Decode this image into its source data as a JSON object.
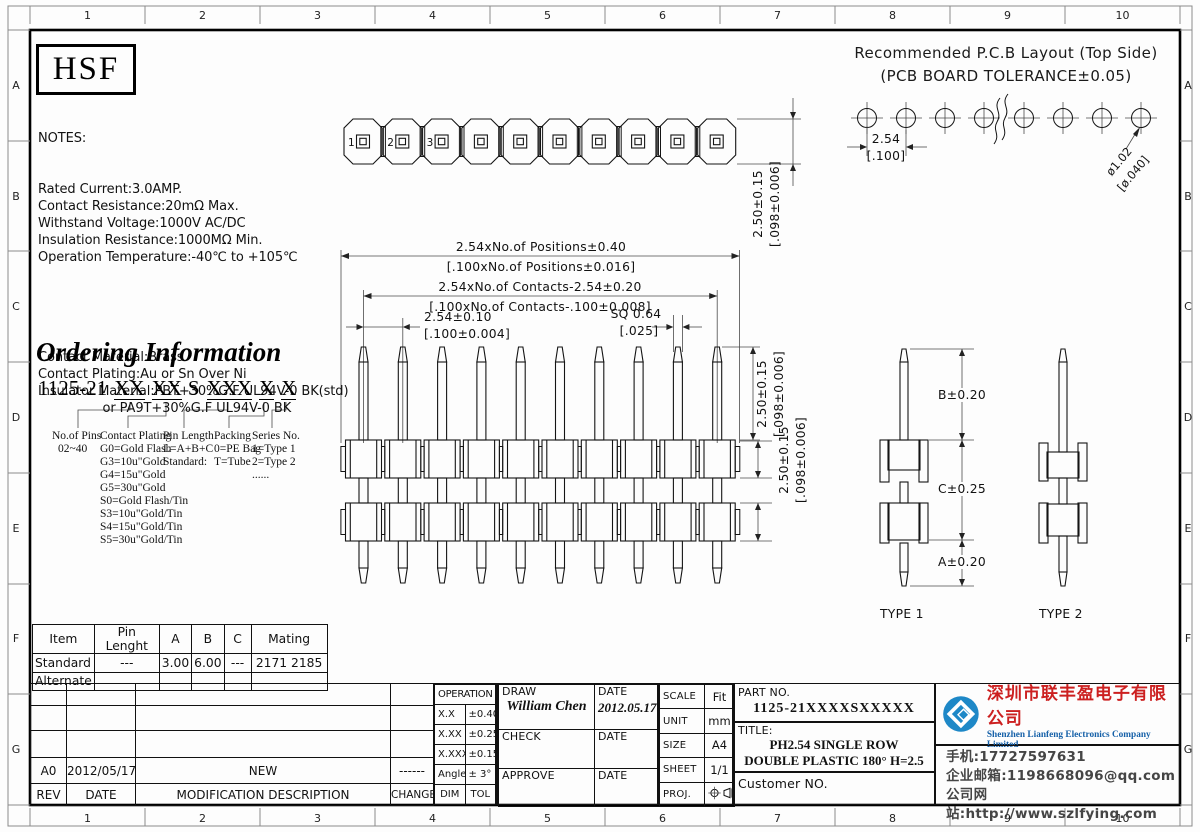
{
  "sheet": {
    "numbers": [
      "1",
      "2",
      "3",
      "4",
      "5",
      "6",
      "7",
      "8",
      "9",
      "10"
    ],
    "letters": [
      "A",
      "B",
      "C",
      "D",
      "E",
      "F",
      "G"
    ]
  },
  "header": {
    "logo": "HSF"
  },
  "notes": {
    "heading": "NOTES:",
    "electrical": [
      "Rated Current:3.0AMP.",
      "Contact Resistance:20mΩ Max.",
      "Withstand Voltage:1000V AC/DC",
      "Insulation Resistance:1000MΩ Min.",
      "Operation Temperature:-40℃ to +105℃"
    ],
    "material": [
      "Contact Material:Brass",
      "Contact Plating:Au or Sn Over Ni",
      "Insulator Material:PBT+30%G.F UL94V-0 BK(std)",
      "                or PA9T+30%G.F UL94V-0 BK"
    ]
  },
  "pcb": {
    "title1": "Recommended P.C.B Layout (Top Side)",
    "title2": "(PCB BOARD TOLERANCE±0.05)",
    "pitch_mm": "2.54",
    "pitch_in": "[.100]",
    "hole_mm": "ø1.02",
    "hole_in": "[ø.040]"
  },
  "ordering": {
    "heading": "Ordering Information",
    "code": {
      "prefix": "1125-21",
      "g1": "XX",
      "g2": "XX",
      "g3": "S",
      "g4": "XXX",
      "g5": "X",
      "g6": "X"
    },
    "columns": [
      {
        "title": "No.of Pins",
        "items": "02~40"
      },
      {
        "title": "Contact Plating",
        "items": "G0=Gold Flash\nG3=10u\"Gold\nG4=15u\"Gold\nG5=30u\"Gold\nS0=Gold Flash/Tin\nS3=10u\"Gold/Tin\nS4=15u\"Gold/Tin\nS5=30u\"Gold/Tin"
      },
      {
        "title": "Pin Length",
        "items": "L=A+B+C\nStandard:"
      },
      {
        "title": "Packing",
        "items": "0=PE Bag\nT=Tube"
      },
      {
        "title": "Series No.",
        "items": "1=Type 1\n2=Type 2\n......"
      }
    ]
  },
  "dims": {
    "positions_mm": "2.54xNo.of Positions±0.40",
    "positions_in": "[.100xNo.of Positions±0.016]",
    "contacts_mm": "2.54xNo.of Contacts-2.54±0.20",
    "contacts_in": "[.100xNo.of Contacts-.100±0.008]",
    "pitch_mm": "2.54±0.10",
    "pitch_in": "[.100±0.004]",
    "sq_mm": "SQ 0.64",
    "sq_in": "[.025]",
    "h_mm": "2.50±0.15",
    "h_in": "[.098±0.006]",
    "b": "B±0.20",
    "c": "C±0.25",
    "a": "A±0.20"
  },
  "views": {
    "pin_numbers": [
      "1",
      "2",
      "3"
    ],
    "type1": "TYPE 1",
    "type2": "TYPE 2"
  },
  "spec_table": {
    "headers": [
      "Item",
      "Pin Lenght",
      "A",
      "B",
      "C",
      "Mating"
    ],
    "rows": [
      [
        "Standard",
        "---",
        "3.00",
        "6.00",
        "---",
        "2171 2185"
      ],
      [
        "Alternate",
        "",
        "",
        "",
        "",
        ""
      ]
    ]
  },
  "revision": {
    "entry": {
      "rev": "A0",
      "date": "2012/05/17",
      "desc": "NEW",
      "change": "------"
    },
    "header": {
      "rev": "REV",
      "date": "DATE",
      "desc": "MODIFICATION  DESCRIPTION",
      "change": "CHANGE"
    }
  },
  "titleblock": {
    "operation": "OPERATION",
    "tol_rows": [
      [
        "X.X",
        "±0.40"
      ],
      [
        "X.XX",
        "±0.25"
      ],
      [
        "X.XXX",
        "±0.15"
      ],
      [
        "Angle",
        "± 3°"
      ],
      [
        "DIM",
        "TOL"
      ]
    ],
    "draw_label": "DRAW",
    "draw_name": "William Chen",
    "date_label": "DATE",
    "draw_date": "2012.05.17",
    "check_label": "CHECK",
    "approve_label": "APPROVE",
    "scale_label": "SCALE",
    "scale_value": "Fit",
    "unit_label": "UNIT",
    "unit_value": "mm",
    "size_label": "SIZE",
    "size_value": "A4",
    "sheet_label": "SHEET",
    "sheet_value": "1/1",
    "proj_label": "PROJ.",
    "part_label": "PART NO.",
    "part_value": "1125-21XXXXSXXXXX",
    "title_label": "TITLE:",
    "title_line1": "PH2.54 SINGLE ROW",
    "title_line2": "DOUBLE PLASTIC 180° H=2.5",
    "customer_label": "Customer NO."
  },
  "company": {
    "cn": "深圳市联丰盈电子有限公司",
    "en": "Shenzhen Lianfeng Electronics Company Limited",
    "phone": "手机:17727597631",
    "email": "企业邮箱:1198668096@qq.com",
    "web": "公司网站:http://www.szlfying.com",
    "brand_blue": "#1e88c7",
    "brand_red": "#cc2020",
    "en_blue": "#1560a8"
  }
}
